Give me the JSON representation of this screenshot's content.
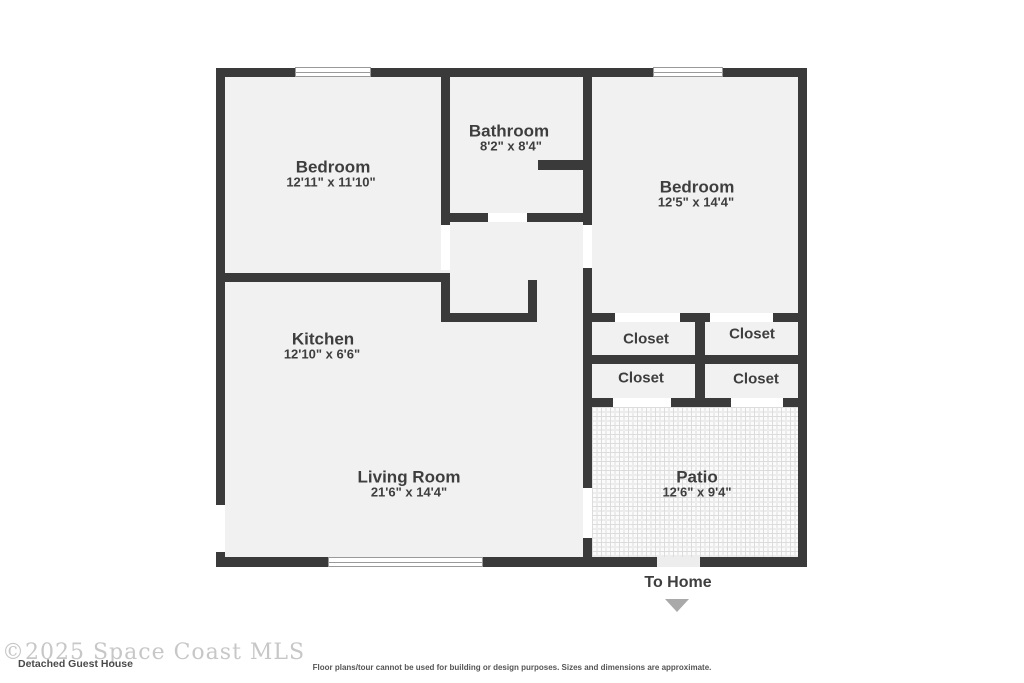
{
  "colors": {
    "canvas_bg": "#ffffff",
    "wall": "#3a3a3a",
    "room_fill": "#f1f1f1",
    "label": "#3e3e3e",
    "window_frame": "#9a9a9a",
    "door_gap": "#ffffff",
    "patio_opening": "#ededed",
    "patio_tile_bg": "#fbfbfb",
    "patio_tile_line": "#dcdcdc",
    "patio_tile_line2": "#ececec",
    "arrow": "#a9a9a9",
    "watermark": "#c7c7c7",
    "plan_title": "#4a4a4a",
    "disclaimer": "#555555"
  },
  "rooms": [
    {
      "name": "Bedroom",
      "dims": "12'11\" x 11'10\""
    },
    {
      "name": "Bathroom",
      "dims": "8'2\" x 8'4\""
    },
    {
      "name": "Bedroom",
      "dims": "12'5\" x 14'4\""
    },
    {
      "name": "Kitchen",
      "dims": "12'10\" x 6'6\""
    },
    {
      "name": "Living Room",
      "dims": "21'6\" x 14'4\""
    },
    {
      "name": "Patio",
      "dims": "12'6\" x 9'4\""
    }
  ],
  "closets": [
    "Closet",
    "Closet",
    "Closet",
    "Closet"
  ],
  "navigation": {
    "to_home_label": "To Home",
    "arrow_icon": "triangle-down"
  },
  "footer": {
    "watermark": "©2025 Space Coast MLS",
    "plan_title": "Detached Guest House",
    "disclaimer": "Floor plans/tour cannot be used for building or design purposes. Sizes and dimensions are approximate."
  }
}
